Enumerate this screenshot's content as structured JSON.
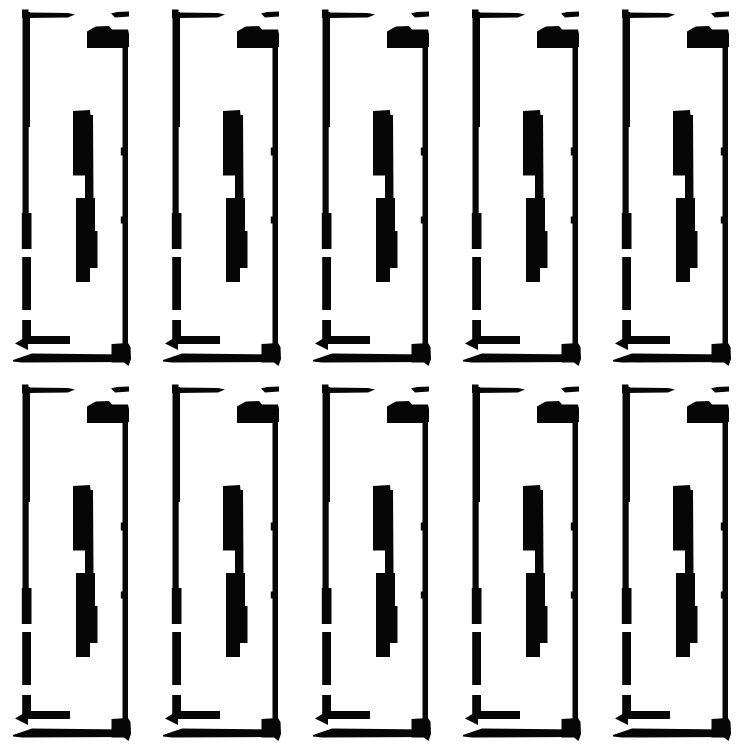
{
  "canvas": {
    "width": 750,
    "height": 750,
    "background_color": "#ffffff"
  },
  "grid": {
    "columns": 5,
    "rows": 2,
    "cell_width": 150,
    "cell_height": 375,
    "tile_count": 10
  },
  "tile": {
    "name": "adhesive-strip-outline",
    "color": "#060606",
    "shapes": [
      {
        "name": "top-left-tick",
        "type": "rect",
        "x": 22,
        "y": 9.5,
        "w": 6.5,
        "h": 8.5
      },
      {
        "name": "top-left-line",
        "type": "polygon",
        "points": [
          [
            28,
            12.5
          ],
          [
            68,
            13
          ],
          [
            75,
            14.5
          ],
          [
            68,
            17.5
          ],
          [
            28,
            18
          ]
        ]
      },
      {
        "name": "top-right-dash",
        "type": "polygon",
        "points": [
          [
            111,
            13.5
          ],
          [
            117,
            12
          ],
          [
            129,
            11.5
          ],
          [
            129,
            16.5
          ],
          [
            115,
            17.5
          ]
        ]
      },
      {
        "name": "top-right-blob",
        "type": "polygon",
        "points": [
          [
            87,
            31.5
          ],
          [
            93,
            28
          ],
          [
            96,
            26.5
          ],
          [
            109,
            26
          ],
          [
            112,
            29.5
          ],
          [
            128,
            29.5
          ],
          [
            129,
            34
          ],
          [
            129,
            47
          ],
          [
            123,
            48
          ],
          [
            87,
            48
          ]
        ]
      },
      {
        "name": "right-vertical-line",
        "type": "rect",
        "x": 122.5,
        "y": 45,
        "w": 5.5,
        "h": 301
      },
      {
        "name": "right-nub-upper",
        "type": "rect",
        "x": 120.8,
        "y": 147.5,
        "w": 2.4,
        "h": 8
      },
      {
        "name": "right-nub-lower",
        "type": "rect",
        "x": 120.8,
        "y": 216.5,
        "w": 2.4,
        "h": 7
      },
      {
        "name": "left-segment-1",
        "type": "rect",
        "x": 22.5,
        "y": 12,
        "w": 7.5,
        "h": 115
      },
      {
        "name": "left-segment-2",
        "type": "rect",
        "x": 22.5,
        "y": 127,
        "w": 6.2,
        "h": 86
      },
      {
        "name": "left-segment-3",
        "type": "rect",
        "x": 21.8,
        "y": 213,
        "w": 9.7,
        "h": 36
      },
      {
        "name": "left-segment-4",
        "type": "rect",
        "x": 22.2,
        "y": 257,
        "w": 8.8,
        "h": 53
      },
      {
        "name": "left-segment-5",
        "type": "rect",
        "x": 22.2,
        "y": 320,
        "w": 8.8,
        "h": 24
      },
      {
        "name": "bottom-left-line",
        "type": "rect",
        "x": 26,
        "y": 336,
        "w": 44,
        "h": 8
      },
      {
        "name": "bottom-left-arrow-tip",
        "type": "polygon",
        "points": [
          [
            15,
            343.5
          ],
          [
            28,
            335.5
          ],
          [
            28,
            350
          ]
        ]
      },
      {
        "name": "bottom-long-line",
        "type": "polygon",
        "points": [
          [
            13,
            360
          ],
          [
            32,
            353.5
          ],
          [
            129,
            354.5
          ],
          [
            129,
            362
          ],
          [
            22,
            362.5
          ],
          [
            13,
            361.5
          ]
        ]
      },
      {
        "name": "bottom-right-blob",
        "type": "polygon",
        "points": [
          [
            111.5,
            344
          ],
          [
            128,
            343
          ],
          [
            130.5,
            347
          ],
          [
            131,
            359
          ],
          [
            128.5,
            366
          ],
          [
            124,
            362.5
          ],
          [
            111.5,
            362.5
          ]
        ]
      },
      {
        "name": "middle-upper-bar",
        "type": "polygon",
        "points": [
          [
            73,
            111
          ],
          [
            90,
            110
          ],
          [
            90.5,
            115
          ],
          [
            93,
            115
          ],
          [
            93.5,
            198
          ],
          [
            85,
            198
          ],
          [
            85,
            175.5
          ],
          [
            73,
            175.5
          ]
        ]
      },
      {
        "name": "middle-lower-bar",
        "type": "polygon",
        "points": [
          [
            76,
            198
          ],
          [
            95,
            198
          ],
          [
            95,
            231
          ],
          [
            97.5,
            231
          ],
          [
            97.5,
            268
          ],
          [
            90,
            268
          ],
          [
            90,
            282
          ],
          [
            76,
            282
          ]
        ]
      }
    ]
  }
}
